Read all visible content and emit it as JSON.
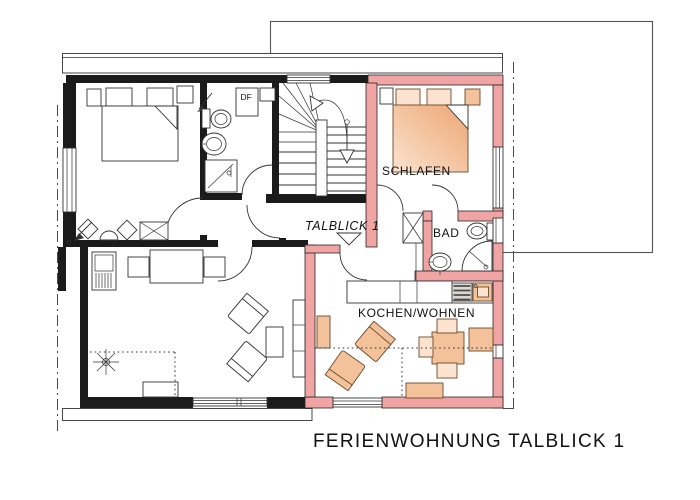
{
  "title": "FERIENWOHNUNG TALBLICK 1",
  "labels": {
    "caption": "FERIENWOHNUNG  TALBLICK 1",
    "apartment": "TALBLICK 1",
    "bedroom": "SCHLAFEN",
    "bathroom": "BAD",
    "kitchen_living": "KOCHEN/WOHNEN",
    "roof_window": "DF"
  },
  "colors": {
    "apartment_wall": "#f0a4a4",
    "furniture_light": "#fbe3cf",
    "furniture_mid": "#f3c29a",
    "furniture_deep": "#eda673",
    "wall_black": "#1b1b1b",
    "stove_dark": "#4d4d4d",
    "line": "#2e2e2e",
    "background": "#ffffff"
  }
}
